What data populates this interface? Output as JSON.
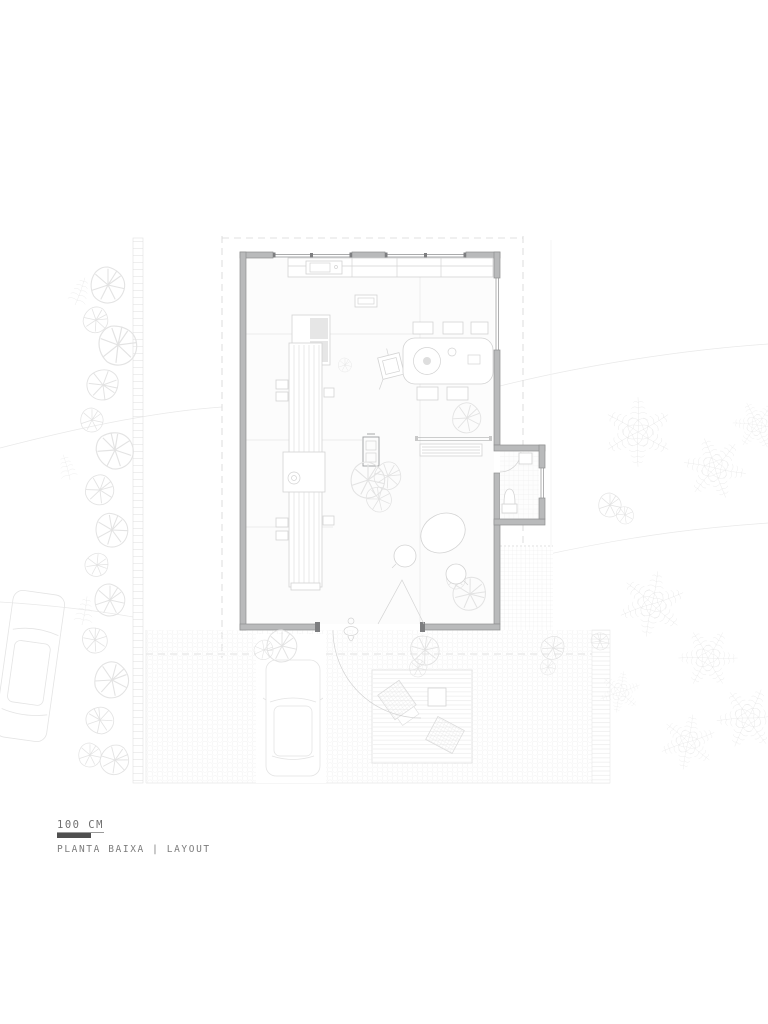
{
  "title_block": {
    "scale_label": "100 CM",
    "plan_title": "PLANTA BAIXA | LAYOUT"
  },
  "colors": {
    "paper": "#ffffff",
    "wall_fill": "#b9babb",
    "wall_edge": "#8f9091",
    "wall_dark": "#7d7e80",
    "furniture_line": "#d3d3d3",
    "furniture_strong": "#9c9d9e",
    "faint_line": "#e9e9e9",
    "vegetation": "#e3e3e3",
    "paving": "#efefef",
    "car_line": "#e4e4e4",
    "dashed_boundary": "#d6d6d6",
    "interior_floor": "#fcfcfc",
    "panel": "#e6e6e6",
    "scale_bar": "#4f4f4f",
    "label_text": "#6f6f6f",
    "subtitle_text": "#7c7c7c"
  }
}
